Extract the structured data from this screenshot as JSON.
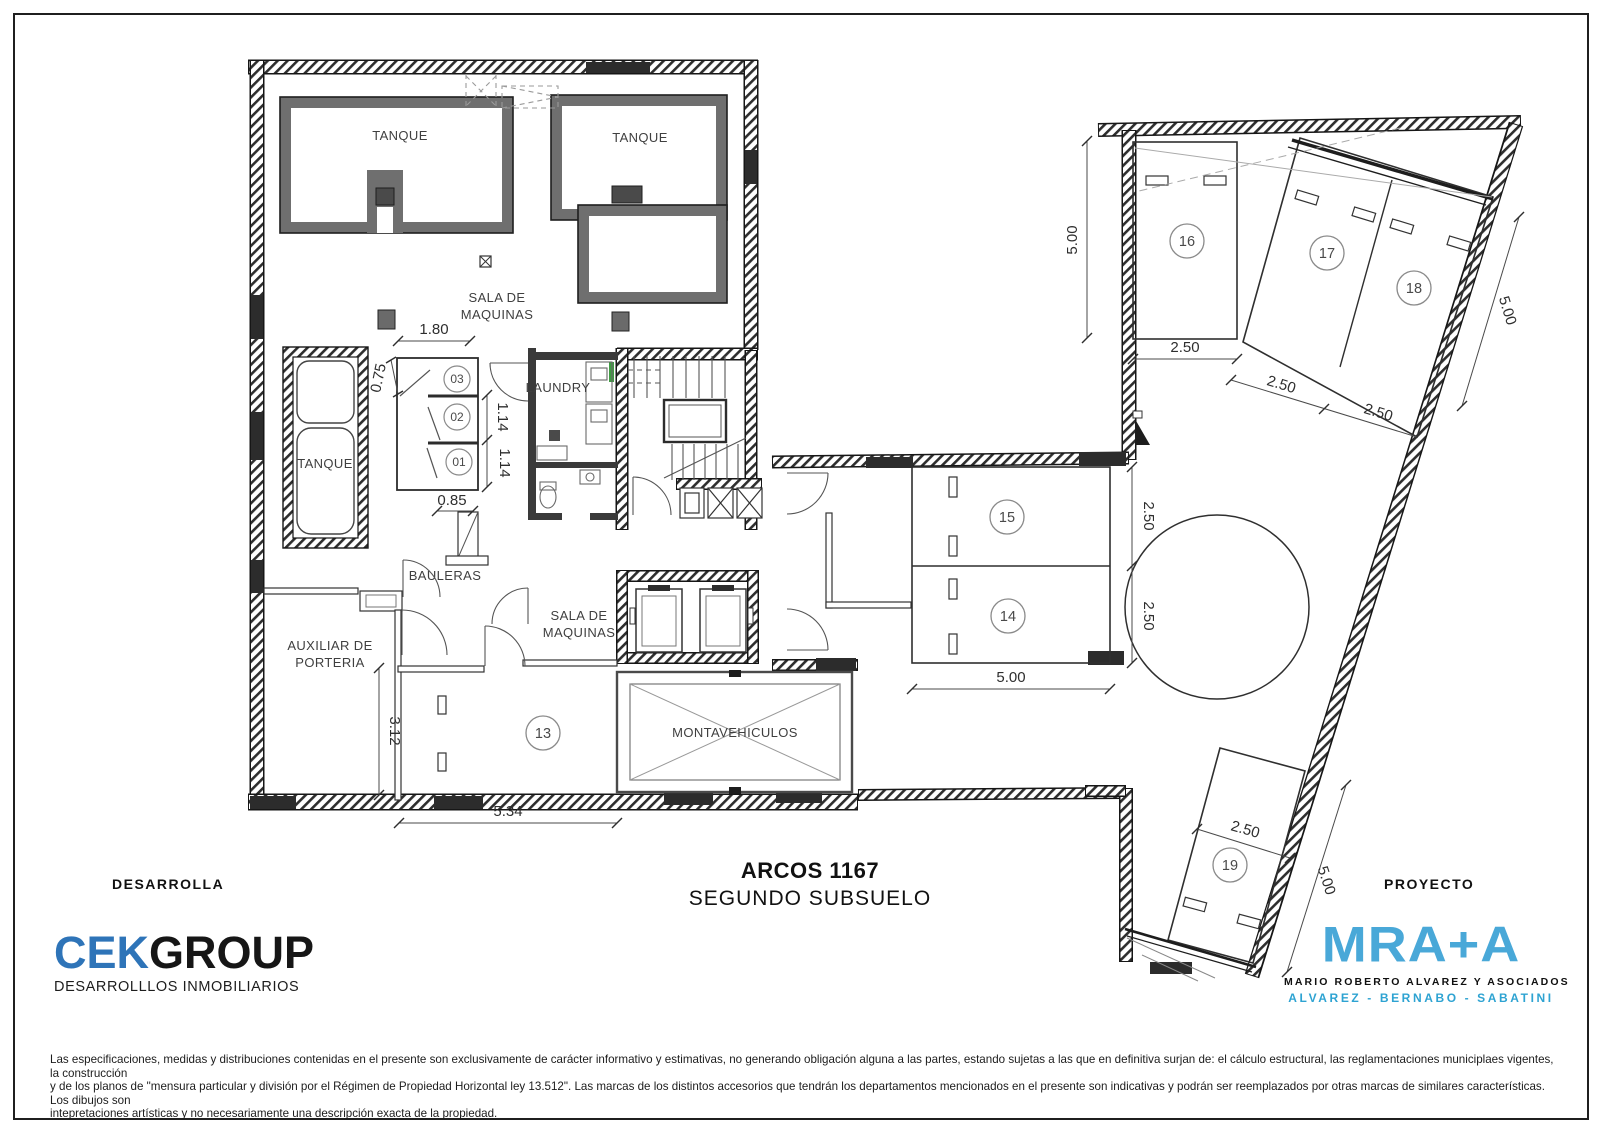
{
  "sheet": {
    "title_line1": "ARCOS 1167",
    "title_line2": "SEGUNDO SUBSUELO",
    "developer_heading": "DESARROLLA",
    "project_heading": "PROYECTO"
  },
  "developer_logo": {
    "name_part1": "CEK",
    "name_part2": "GROUP",
    "tagline": "DESARROLLLOS INMOBILIARIOS",
    "accent_color": "#2e74b8"
  },
  "architect_logo": {
    "name": "MRA+A",
    "subline1": "MARIO ROBERTO ALVAREZ Y ASOCIADOS",
    "subline2": "ALVAREZ - BERNABO - SABATINI",
    "accent_color": "#49a8d8"
  },
  "disclaimer": {
    "line1": "Las especificaciones, medidas y distribuciones contenidas en el presente son exclusivamente de carácter informativo y estimativas, no generando obligación alguna a las partes, estando sujetas a las que en definitiva surjan de: el cálculo estructural, las reglamentaciones municiplaes vigentes, la construcción",
    "line2": "y de los planos de \"mensura particular y división por el Régimen de Propiedad Horizontal ley 13.512\". Las marcas de los distintos accesorios que tendrán los departamentos mencionados en el presente son indicativas y podrán ser reemplazados por otras marcas de similares características. Los dibujos son",
    "line3": "intepretaciones artísticas y no necesariamente una descripción exacta de la propiedad."
  },
  "plan": {
    "room_labels": {
      "tank_top_left": "TANQUE",
      "tank_top_right": "TANQUE",
      "machine_room_upper_l1": "SALA DE",
      "machine_room_upper_l2": "MAQUINAS",
      "tank_left": "TANQUE",
      "laundry": "LAUNDRY",
      "storage_lockers": "BAULERAS",
      "porter_aux_l1": "AUXILIAR DE",
      "porter_aux_l2": "PORTERIA",
      "machine_room_lower_l1": "SALA DE",
      "machine_room_lower_l2": "MAQUINAS",
      "car_lift": "MONTAVEHICULOS"
    },
    "unit_numbers": {
      "u01": "01",
      "u02": "02",
      "u03": "03",
      "u13": "13",
      "u14": "14",
      "u15": "15",
      "u16": "16",
      "u17": "17",
      "u18": "18",
      "u19": "19"
    },
    "dimensions": {
      "d_1_80": "1.80",
      "d_0_75": "0.75",
      "d_1_14_a": "1.14",
      "d_1_14_b": "1.14",
      "d_0_85": "0.85",
      "d_3_12": "3.12",
      "d_5_34": "5.34",
      "d_5_00_left": "5.00",
      "d_2_50_p16": "2.50",
      "d_2_50_p17": "2.50",
      "d_2_50_p18": "2.50",
      "d_5_00_right": "5.00",
      "d_2_50_p15": "2.50",
      "d_2_50_p14": "2.50",
      "d_5_00_p14": "5.00",
      "d_2_50_p19": "2.50",
      "d_5_00_p19": "5.00"
    }
  }
}
